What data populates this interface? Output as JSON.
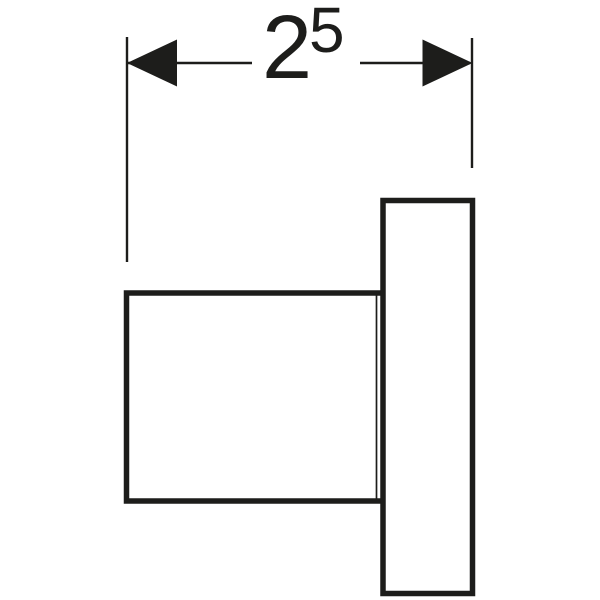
{
  "colors": {
    "line": "#1d1d1b",
    "background": "#ffffff"
  },
  "dimension": {
    "value": "2",
    "superscript": "5",
    "label": "25"
  },
  "figure": {
    "shapes": [
      "part-body",
      "part-flange"
    ],
    "annotation_type": "linear-dimension"
  }
}
